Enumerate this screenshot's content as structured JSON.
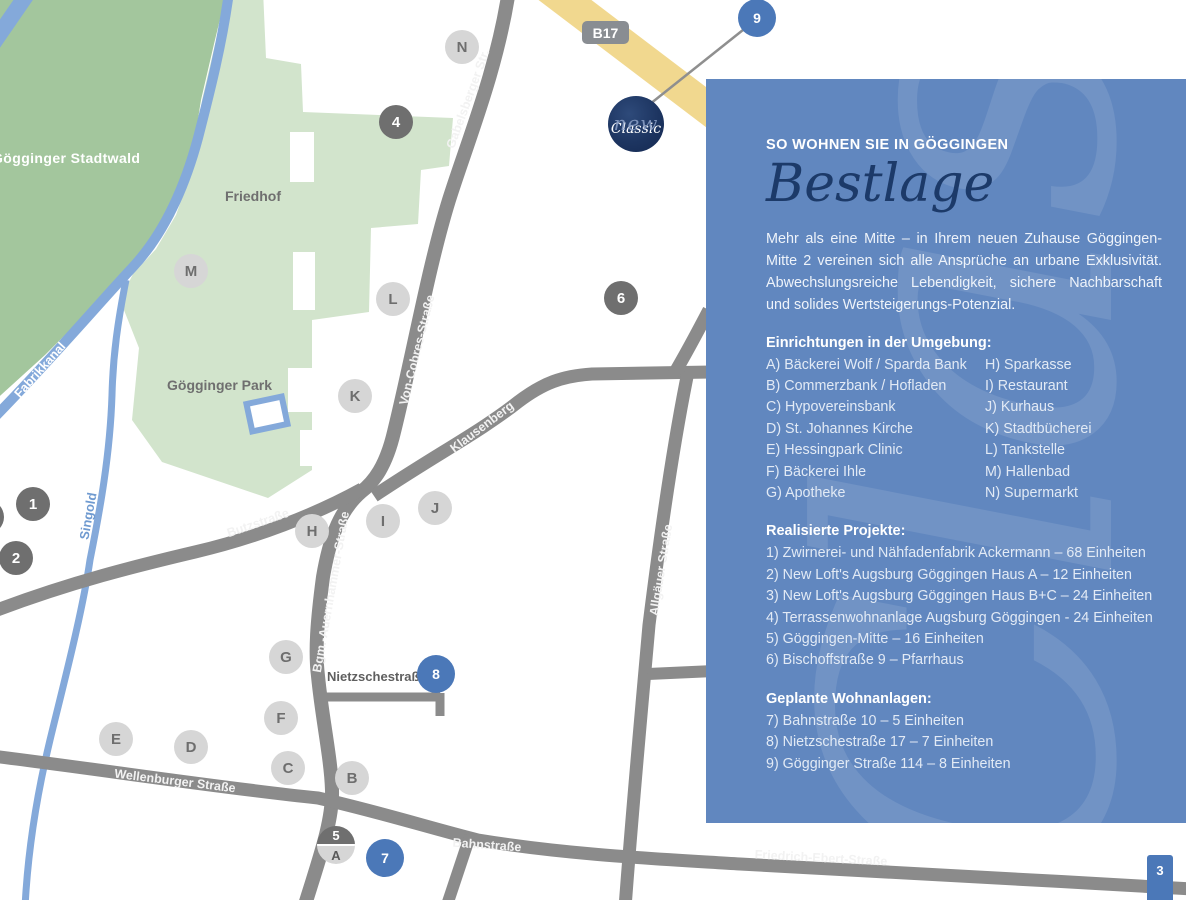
{
  "colors": {
    "panel_blue": "#6187bf",
    "marker_blue": "#4b78b8",
    "marker_dark": "#6f6f6f",
    "marker_light": "#d6d6d6",
    "road_gray": "#8b8b8b",
    "highway_yellow": "#f1d88f",
    "water_blue": "#84a9da",
    "forest_green": "#a3c69d",
    "park_green": "#d2e4cc",
    "title_navy": "#1c3a69"
  },
  "map": {
    "areas": {
      "stadtwald": "Gögginger Stadtwald",
      "friedhof": "Friedhof",
      "park": "Gögginger Park"
    },
    "waters": {
      "fabrikkanal": "Fabrikkanal",
      "singold": "Singold"
    },
    "streets": {
      "gabelsberger": "Gabelsberger Str.",
      "von_cobres": "Von-Cobres-Straße",
      "klausenberg": "Klausenberg",
      "butz": "Butzstraße",
      "bgm": "Bgm.-Auernhammer-Straße",
      "allgaeuer": "Allgäuer Straße",
      "wellenburger": "Wellenburger Straße",
      "bahn": "Bahnstraße",
      "friedrich_ebert": "Friedrich-Ebert-Straße",
      "nietzsche": "Nietzschestraße"
    },
    "route_badge": "B17",
    "logo": {
      "line1": "new",
      "line2": "Classic"
    },
    "markers": {
      "letters": {
        "a": "A",
        "b": "B",
        "c": "C",
        "d": "D",
        "e": "E",
        "f": "F",
        "g": "G",
        "h": "H",
        "i": "I",
        "j": "J",
        "k": "K",
        "l": "L",
        "m": "M",
        "n": "N"
      },
      "numbers": {
        "1": "1",
        "2": "2",
        "4": "4",
        "5": "5",
        "6": "6",
        "7": "7",
        "8": "8",
        "9": "9"
      }
    }
  },
  "panel": {
    "kicker": "SO WOHNEN SIE IN GÖGGINGEN",
    "title": "Bestlage",
    "intro": "Mehr als eine Mitte – in Ihrem neuen Zuhause Göggingen-Mitte 2 vereinen sich alle Ansprüche an urbane Exklusivität. Abwechslungsreiche Lebendigkeit, sichere Nachbarschaft und solides Wertsteigerungs-Potenzial.",
    "facilities": {
      "title": "Einrichtungen in der Umgebung:",
      "left": [
        "A) Bäckerei Wolf / Sparda Bank",
        "B) Commerzbank / Hofladen",
        "C) Hypovereinsbank",
        "D) St. Johannes Kirche",
        "E) Hessingpark Clinic",
        "F) Bäckerei Ihle",
        "G) Apotheke"
      ],
      "right": [
        "H) Sparkasse",
        "I) Restaurant",
        "J) Kurhaus",
        "K) Stadtbücherei",
        "L) Tankstelle",
        "M) Hallenbad",
        "N) Supermarkt"
      ]
    },
    "projects": {
      "title": "Realisierte Projekte:",
      "items": [
        "1) Zwirnerei- und Nähfadenfabrik Ackermann – 68 Einheiten",
        "2) New Loft's Augsburg Göggingen Haus A – 12 Einheiten",
        "3) New Loft's Augsburg Göggingen Haus B+C – 24 Einheiten",
        "4) Terrassenwohnanlage Augsburg Göggingen - 24 Einheiten",
        "5) Göggingen-Mitte – 16 Einheiten",
        "6) Bischoffstraße 9 – Pfarrhaus"
      ]
    },
    "planned": {
      "title": "Geplante Wohnanlagen:",
      "items": [
        "7) Bahnstraße 10 – 5 Einheiten",
        "8) Nietzschestraße 17 – 7 Einheiten",
        "9) Gögginger Straße 114 – 8 Einheiten"
      ]
    }
  },
  "page_number": "3"
}
